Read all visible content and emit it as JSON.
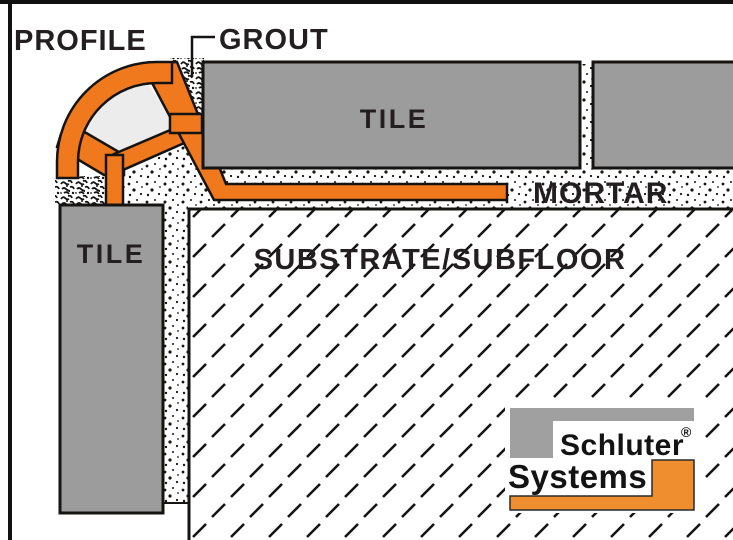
{
  "diagram": {
    "type": "tile-edge-profile-installation-cross-section",
    "labels": {
      "profile": "PROFILE",
      "grout": "GROUT",
      "tile_top": "TILE",
      "tile_wall": "TILE",
      "mortar": "MORTAR",
      "substrate": "SUBSTRATE/SUBFLOOR"
    },
    "logo": {
      "line1": "Schluter",
      "registered_mark": "®",
      "line2": "Systems"
    },
    "colors": {
      "profile_orange": "#F0791E",
      "logo_orange": "#EF8E2F",
      "tile_gray": "#9C9C9C",
      "logo_gray": "#A0A0A0",
      "chamber_gray": "#ECECEC",
      "label_black": "#231F20",
      "outline_black": "#161412",
      "logo_bg": "#FFFFFF"
    }
  }
}
